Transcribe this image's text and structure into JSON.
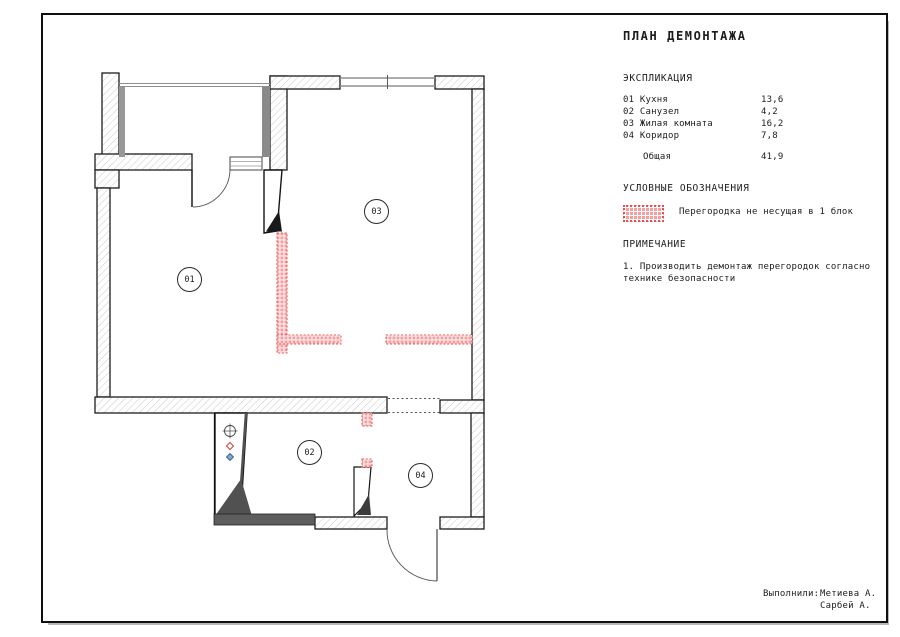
{
  "title": "ПЛАН ДЕМОНТАЖА",
  "explication": {
    "header": "ЭКСПЛИКАЦИЯ",
    "rows": [
      {
        "label": "01 Кухня",
        "value": "13,6"
      },
      {
        "label": "02 Санузел",
        "value": "4,2"
      },
      {
        "label": "03 Жилая комната",
        "value": "16,2"
      },
      {
        "label": "04 Коридор",
        "value": "7,8"
      }
    ],
    "total": {
      "label": "Общая",
      "value": "41,9"
    }
  },
  "legend": {
    "header": "УСЛОВНЫЕ ОБОЗНАЧЕНИЯ",
    "items": [
      {
        "icon": "pink-dashed-partition-swatch",
        "label": "Перегородка не несущая в 1 блок"
      }
    ]
  },
  "notes": {
    "header": "ПРИМЕЧАНИЕ",
    "lines": [
      "1. Производить демонтаж перегородок согласно",
      "технике безопасности"
    ]
  },
  "credits": {
    "label": "Выполнили:",
    "names": [
      "Метиева А.",
      "Сарбей А."
    ]
  },
  "plan": {
    "room_labels": [
      "01",
      "02",
      "03",
      "04"
    ],
    "icons": [
      "plumbing-riser-icon",
      "hot-water-icon",
      "cold-water-icon"
    ]
  },
  "colors": {
    "partition_fill": "#f5a0a0",
    "partition_stroke": "#e85050",
    "wall_hatch": "#cdcdcd",
    "wall_outline": "#1d1d1d",
    "dark_fill": "#5d5d5d"
  }
}
